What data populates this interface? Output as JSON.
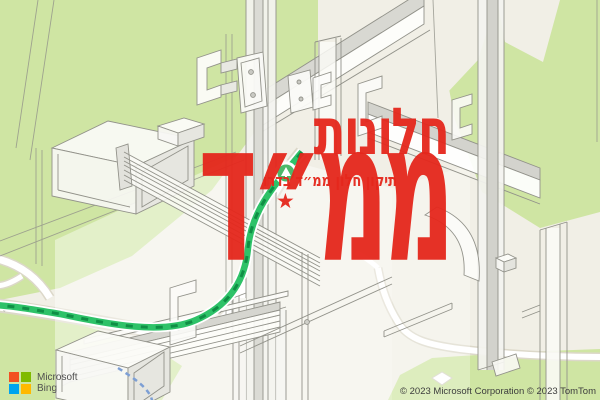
{
  "overlay": {
    "title_line1": "חלונות",
    "title_line2": "ממ״ד",
    "subtitle": "תיקון חלון ממ״ד בדרו",
    "star_glyph": "★",
    "text_color": "#e5271c"
  },
  "map": {
    "road_label": "ut",
    "provider": {
      "logo_line1": "Microsoft",
      "logo_line2": "Bing",
      "logo_colors": {
        "red": "#f25022",
        "green": "#7fba00",
        "blue": "#00a4ef",
        "yellow": "#ffb900"
      }
    },
    "copyright": "© 2023 Microsoft Corporation © 2023 TomTom",
    "colors": {
      "land": "#f1efe6",
      "park_green": "#cfe5a3",
      "road_fill": "#ffffff",
      "road_casing": "#dcd8c9",
      "route_green": "#2ec268",
      "route_dash_green": "#0f8f45",
      "walking_route_blue": "#7d9fd4",
      "poi_green": "#4db96a",
      "drawing_line": "#92928a"
    }
  }
}
